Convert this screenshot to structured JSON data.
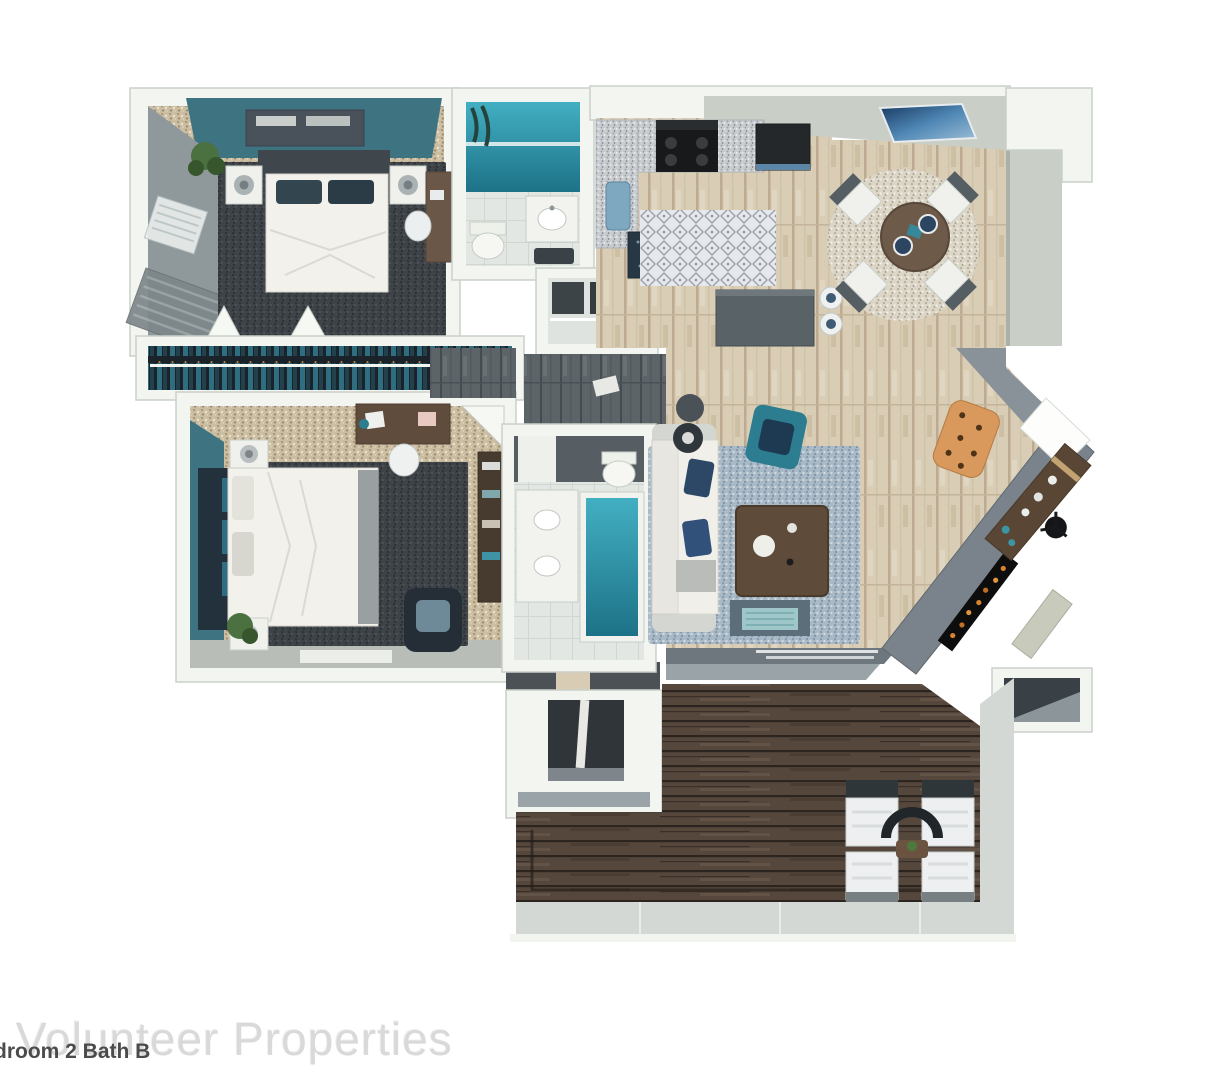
{
  "floor_plan": {
    "watermark": "Volunteer Properties",
    "caption": "droom 2 Bath B"
  },
  "colors": {
    "wall-white": "#f3f5f1",
    "wall-edge": "#c9d0c9",
    "wall-gray": "#c9cec6",
    "wall-dark": "#8f989b",
    "teal-wall": "#3e7481",
    "teal-accent": "#2c7d8f",
    "navy": "#2c4866",
    "water-light": "#43afc2",
    "water-dark": "#1d7287",
    "carpet": "#cbbda2",
    "wood-light": "#d9cdb6",
    "wood-hall": "#5d6468",
    "deck-wood": "#55473c",
    "rug-dark": "#3d4347",
    "rug-blue": "#aab9c6",
    "concrete": "#d4d8d4",
    "watermark": "#d9d9d9",
    "caption": "#4b4b4b"
  }
}
